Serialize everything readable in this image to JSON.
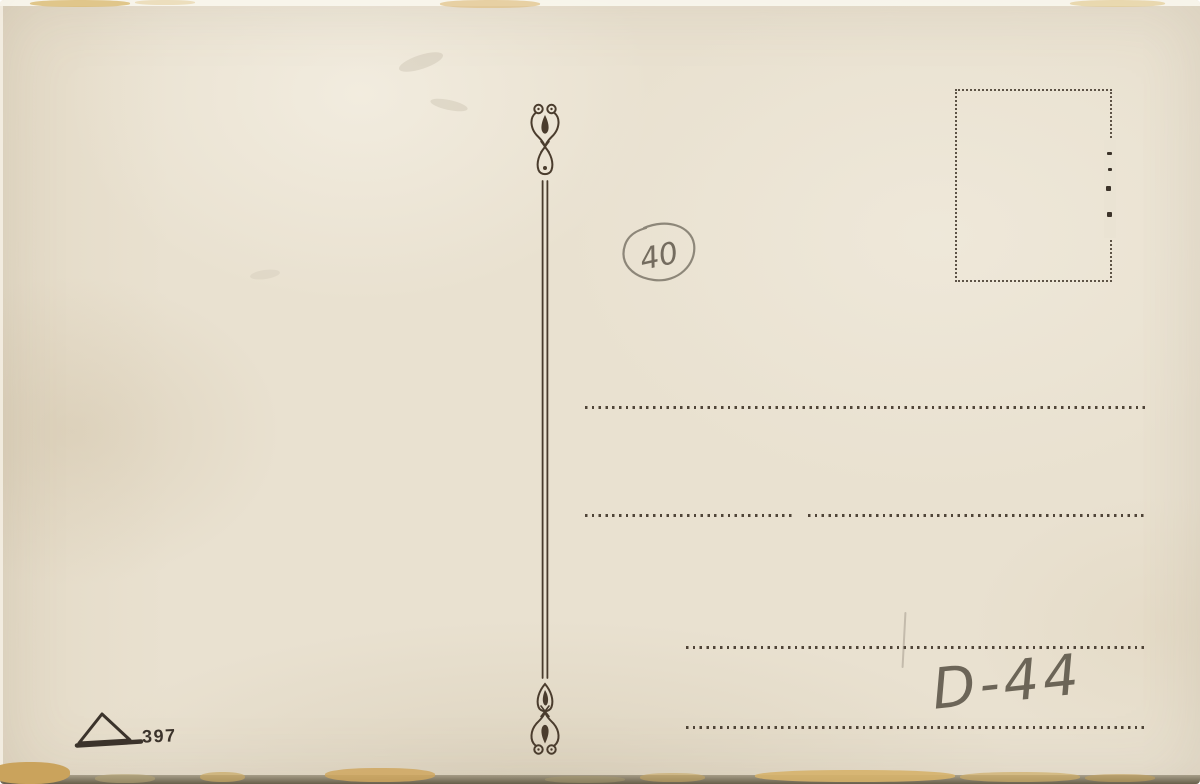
{
  "postcard": {
    "publisher_mark": {
      "icon": "triangle-logo",
      "number": "397"
    },
    "handwriting": {
      "circled_number": "40",
      "code_bottom_right": "D-44"
    },
    "stamp_box": {
      "style": "dotted-rectangle"
    },
    "colors": {
      "paper": "#e9e1d0",
      "printed_ink": "#453a2b",
      "pencil": "#6e6759",
      "edge_tan": "#d7b068",
      "edge_dark": "#675f4a"
    }
  }
}
